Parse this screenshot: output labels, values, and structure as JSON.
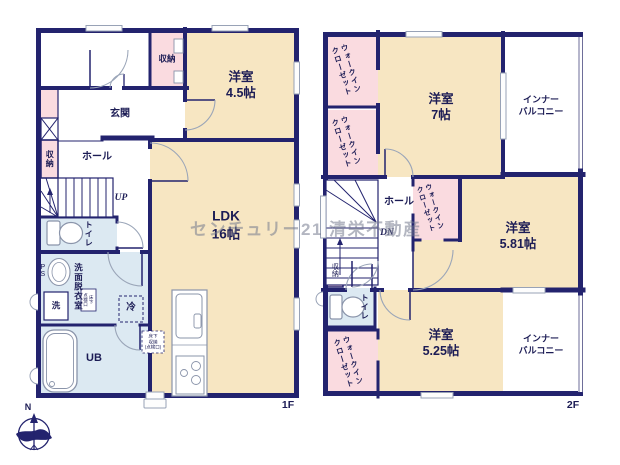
{
  "watermark": "センチュリー21 清栄不動産",
  "compass": {
    "north": "N"
  },
  "colors": {
    "wall": "#23236e",
    "room": "#f7e6c2",
    "closet": "#fadbe0",
    "wet": "#dce9f2",
    "window": "#98a2b6"
  },
  "floor1": {
    "label": "1F",
    "rooms": {
      "storage_top": "収納",
      "bedroom45": "洋室\n4.5帖",
      "entrance": "玄関",
      "storage_hall": "収納",
      "hall": "ホール",
      "stairs_up": "UP",
      "toilet": "トイレ",
      "ps": "PS",
      "washroom": "洗面脱衣室",
      "washer": "洗",
      "underfloor_inspection": "床下\n点検口",
      "fridge": "冷",
      "underfloor_storage": "床下\n収納\n(点検口)",
      "bath": "UB",
      "ldk": "LDK\n16帖"
    }
  },
  "floor2": {
    "label": "2F",
    "rooms": {
      "wic": "ウォークイン\nクローゼット",
      "bedroom7": "洋室\n7帖",
      "inner_balcony": "インナー\nバルコニー",
      "hall": "ホール",
      "stairs_dn": "DN",
      "bedroom581": "洋室\n5.81帖",
      "storage": "収納",
      "toilet": "トイレ",
      "bedroom525": "洋室\n5.25帖"
    }
  }
}
